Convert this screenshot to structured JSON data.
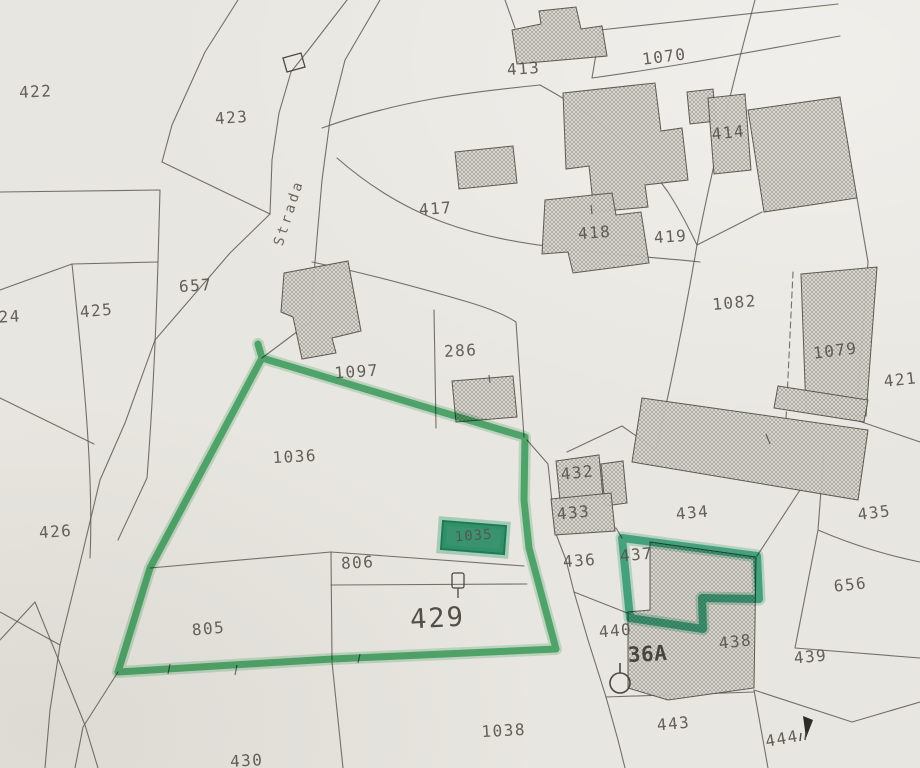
{
  "map": {
    "kind": "cadastral-map-scan",
    "paper_color": "#e8e6e0",
    "line_color": "#5d5a53",
    "highlight": {
      "main_outline_color": "#3aa85f",
      "secondary_outline_color": "#2ea47d",
      "building_fill_color": "#28996f",
      "building_label_color": "#173c2f"
    },
    "road": {
      "label": "Strada"
    },
    "parcel_labels": [
      {
        "id": "422",
        "x": 36,
        "y": 97,
        "rot": -3
      },
      {
        "id": "423",
        "x": 232,
        "y": 123,
        "rot": -4
      },
      {
        "id": "24",
        "x": 10,
        "y": 322,
        "rot": -3
      },
      {
        "id": "425",
        "x": 97,
        "y": 316,
        "rot": -5
      },
      {
        "id": "657",
        "x": 196,
        "y": 291,
        "rot": -4
      },
      {
        "id": "426",
        "x": 56,
        "y": 537,
        "rot": -4
      },
      {
        "id": "413",
        "x": 524,
        "y": 74,
        "rot": -4
      },
      {
        "id": "1070",
        "x": 665,
        "y": 62,
        "rot": -7
      },
      {
        "id": "414",
        "x": 729,
        "y": 138,
        "rot": -6
      },
      {
        "id": "417",
        "x": 436,
        "y": 214,
        "rot": -4
      },
      {
        "id": "418",
        "x": 595,
        "y": 238,
        "rot": -4
      },
      {
        "id": "419",
        "x": 671,
        "y": 242,
        "rot": -4
      },
      {
        "id": "1082",
        "x": 735,
        "y": 308,
        "rot": -5
      },
      {
        "id": "1079",
        "x": 836,
        "y": 356,
        "rot": -7
      },
      {
        "id": "421",
        "x": 901,
        "y": 385,
        "rot": -6
      },
      {
        "id": "286",
        "x": 461,
        "y": 356,
        "rot": -3
      },
      {
        "id": "1097",
        "x": 357,
        "y": 377,
        "rot": -4
      },
      {
        "id": "1036",
        "x": 295,
        "y": 462,
        "rot": -3
      },
      {
        "id": "432",
        "x": 578,
        "y": 478,
        "rot": -6
      },
      {
        "id": "433",
        "x": 574,
        "y": 518,
        "rot": -5
      },
      {
        "id": "434",
        "x": 693,
        "y": 518,
        "rot": -5
      },
      {
        "id": "435",
        "x": 875,
        "y": 518,
        "rot": -7
      },
      {
        "id": "436",
        "x": 580,
        "y": 566,
        "rot": -4
      },
      {
        "id": "437",
        "x": 637,
        "y": 560,
        "rot": -5
      },
      {
        "id": "656",
        "x": 851,
        "y": 590,
        "rot": -6
      },
      {
        "id": "806",
        "x": 358,
        "y": 568,
        "rot": -3
      },
      {
        "id": "805",
        "x": 209,
        "y": 634,
        "rot": -5
      },
      {
        "id": "429",
        "x": 438,
        "y": 627,
        "rot": -3,
        "size": "xl"
      },
      {
        "id": "440",
        "x": 616,
        "y": 636,
        "rot": -5
      },
      {
        "id": "36A",
        "x": 648,
        "y": 661,
        "rot": -3,
        "size": "lg"
      },
      {
        "id": "438",
        "x": 736,
        "y": 647,
        "rot": -6
      },
      {
        "id": "439",
        "x": 811,
        "y": 662,
        "rot": -5
      },
      {
        "id": "443",
        "x": 674,
        "y": 729,
        "rot": -5
      },
      {
        "id": "444",
        "x": 783,
        "y": 744,
        "rot": -10
      },
      {
        "id": "1038",
        "x": 504,
        "y": 736,
        "rot": -3
      },
      {
        "id": "430",
        "x": 247,
        "y": 766,
        "rot": -3
      },
      {
        "id": "1035",
        "x": 474,
        "y": 540,
        "rot": -4,
        "size": "sm",
        "color": "#173c2f"
      },
      {
        "id": "Strada",
        "x": 293,
        "y": 214,
        "rot": -72,
        "size": "road"
      }
    ],
    "symbols": [
      {
        "name": "benchmark-circle",
        "x": 620,
        "y": 683
      },
      {
        "name": "gate-symbol",
        "x": 458,
        "y": 582
      },
      {
        "name": "hut-outline",
        "x": 294,
        "y": 62
      },
      {
        "name": "flag-marker",
        "x": 807,
        "y": 726
      },
      {
        "name": "double-tick",
        "x": 801,
        "y": 737
      }
    ]
  }
}
